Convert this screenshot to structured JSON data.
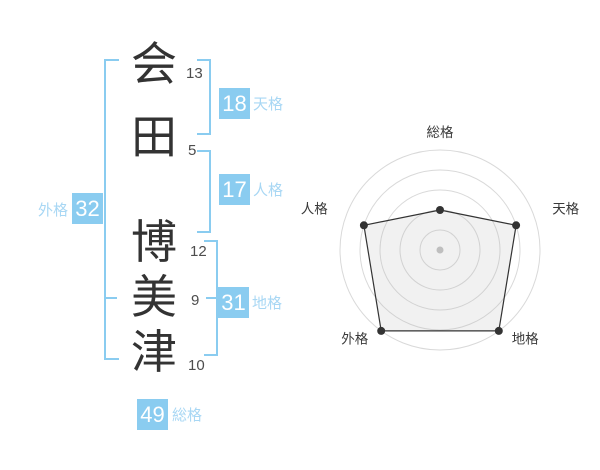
{
  "name": {
    "characters": [
      {
        "char": "会",
        "strokes": "13"
      },
      {
        "char": "田",
        "strokes": "5"
      },
      {
        "char": "博",
        "strokes": "12"
      },
      {
        "char": "美",
        "strokes": "9"
      },
      {
        "char": "津",
        "strokes": "10"
      }
    ]
  },
  "scores": {
    "tenkaku": {
      "value": "18",
      "label": "天格"
    },
    "jinkaku": {
      "value": "17",
      "label": "人格"
    },
    "chikaku": {
      "value": "31",
      "label": "地格"
    },
    "gaikaku": {
      "value": "32",
      "label": "外格"
    },
    "soukaku": {
      "value": "49",
      "label": "総格"
    }
  },
  "colors": {
    "badge_bg": "#8accf0",
    "badge_text": "#ffffff",
    "score_label": "#a8d7f4",
    "bracket": "#8accf0",
    "character_text": "#333333",
    "stroke_count_text": "#4d4d4d",
    "radar_grid": "#d9d9d9",
    "radar_line": "#333333",
    "radar_fill": "rgba(180,180,180,0.18)",
    "radar_center_dot": "#c2c2c2",
    "radar_label": "#3a3a3a"
  },
  "chart_data": {
    "type": "radar",
    "categories": [
      "総格",
      "天格",
      "地格",
      "外格",
      "人格"
    ],
    "values": [
      2,
      4,
      5,
      5,
      4
    ],
    "max": 5,
    "rings": [
      1,
      2,
      3,
      4,
      5
    ],
    "angles_deg": [
      90,
      18,
      -54,
      234,
      162
    ],
    "grid": "concentric-circles",
    "legend": "none",
    "score_values": {
      "総格": 49,
      "天格": 18,
      "地格": 31,
      "外格": 32,
      "人格": 17
    }
  }
}
